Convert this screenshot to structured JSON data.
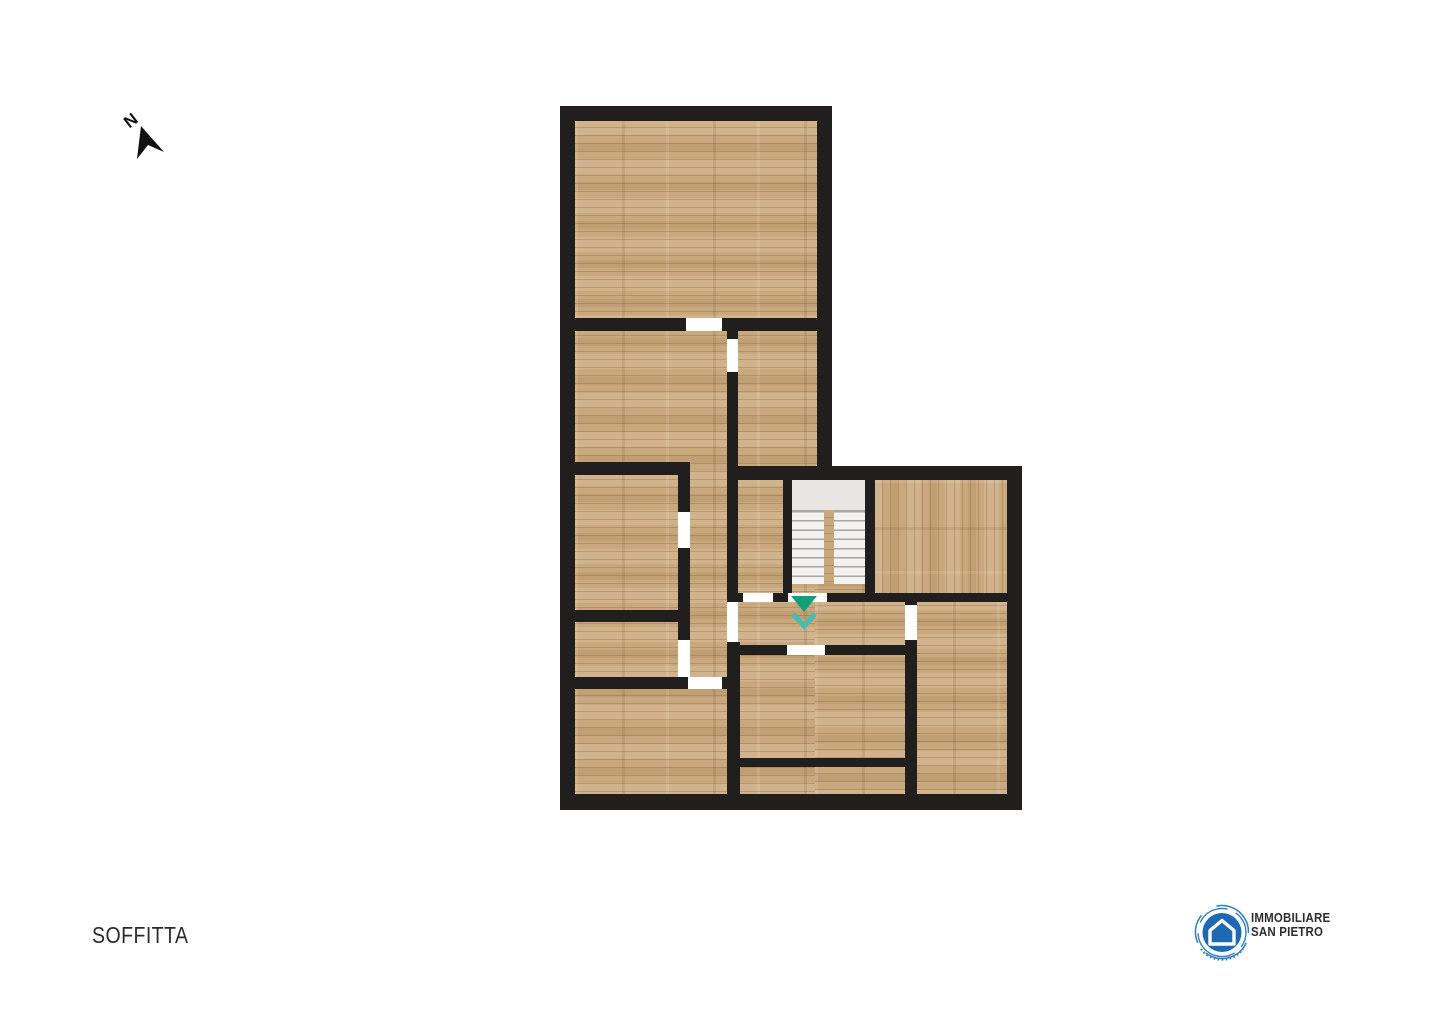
{
  "page": {
    "background": "#ffffff"
  },
  "north_indicator": {
    "label": "N"
  },
  "floor_plan": {
    "floor_label": "SOFFITTA",
    "staircase": {
      "type": "double-flight",
      "direction_marker": "down"
    },
    "colors": {
      "wall": "#201f1d",
      "floor_wood": "#c9a87e",
      "door_opening": "#ffffff",
      "stair_landing": "#e8e6e2",
      "stair_step": "#f3f2f0",
      "stair_step_line": "#a9a7a3",
      "arrow_green": "#12a078",
      "arrow_teal": "#47bdb0"
    }
  },
  "logo": {
    "line1": "IMMOBILIARE",
    "line2": "SAN PIETRO",
    "icon": "house-in-circle",
    "brand_blue": "#1e6ab2",
    "text_color": "#2e2d2d"
  }
}
